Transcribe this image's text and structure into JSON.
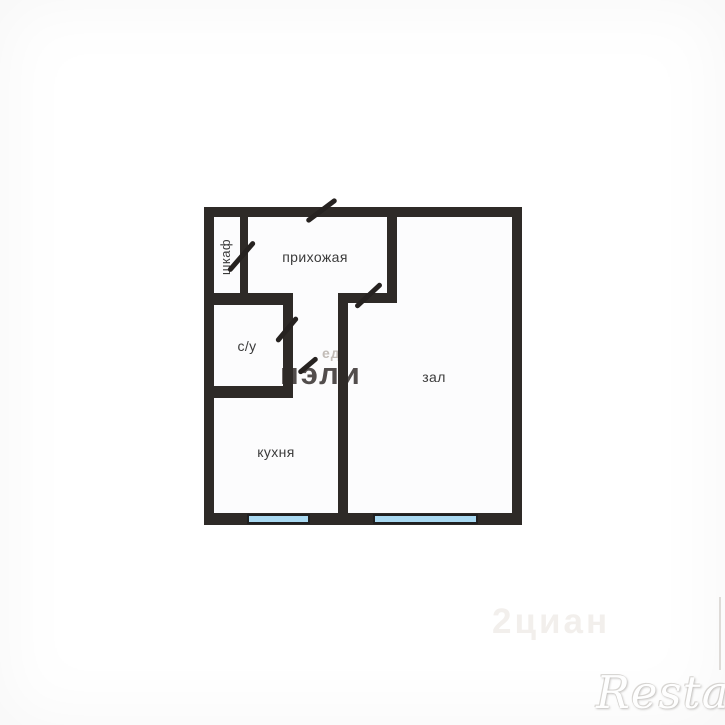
{
  "floorplan": {
    "rooms": {
      "closet": {
        "label": "шкаф"
      },
      "hallway": {
        "label": "прихожая"
      },
      "bathroom": {
        "label": "с/у"
      },
      "kitchen": {
        "label": "кухня"
      },
      "living_room": {
        "label": "зал"
      }
    },
    "features": {
      "windows": [
        "kitchen-window",
        "living-room-window"
      ],
      "door_marks": [
        "entry-door",
        "closet-door",
        "bathroom-door",
        "kitchen-door",
        "living-room-door"
      ]
    },
    "colors": {
      "wall": "#2e2a27",
      "window_fill": "#a9d9f1",
      "window_border": "#1f1f1f",
      "label_text": "#3b3b3b"
    }
  },
  "watermarks": {
    "center_dark": "пэли",
    "center_light": "ед",
    "corner_faint": "2циан",
    "brand": "Restate"
  }
}
